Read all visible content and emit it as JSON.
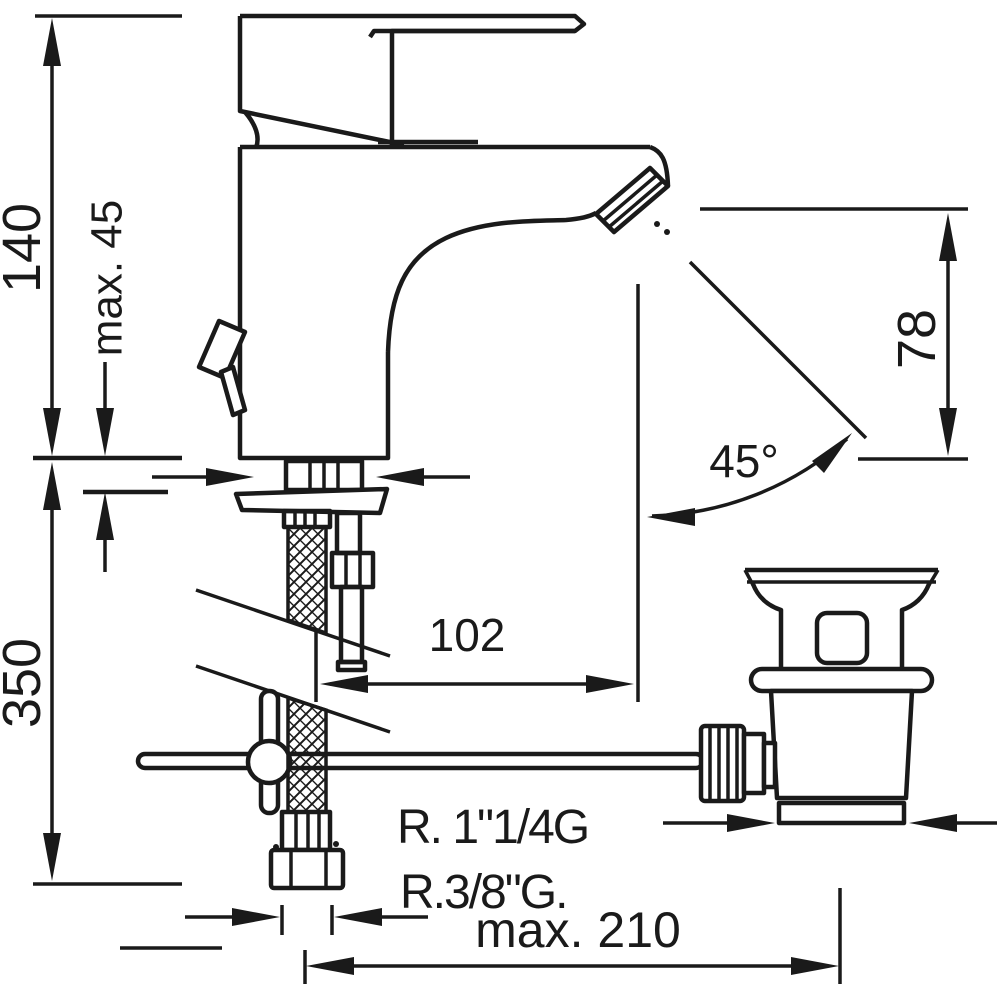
{
  "drawing": {
    "subject": "Single-lever basin mixer faucet with flexible supply hose and pop-up waste drain — side-view installation dimension drawing",
    "background_color": "#ffffff",
    "line_color": "#1a1a1a"
  },
  "dimensions": {
    "total_height": "140",
    "max_deck_thickness": "max. 45",
    "below_deck_depth": "350",
    "spout_outlet_height": "78",
    "outlet_angle": "45°",
    "spout_reach": "102",
    "drain_thread": "R. 1\"1/4G",
    "supply_hose_thread": "R.3/8\"G.",
    "max_drain_rod_reach": "max. 210"
  }
}
